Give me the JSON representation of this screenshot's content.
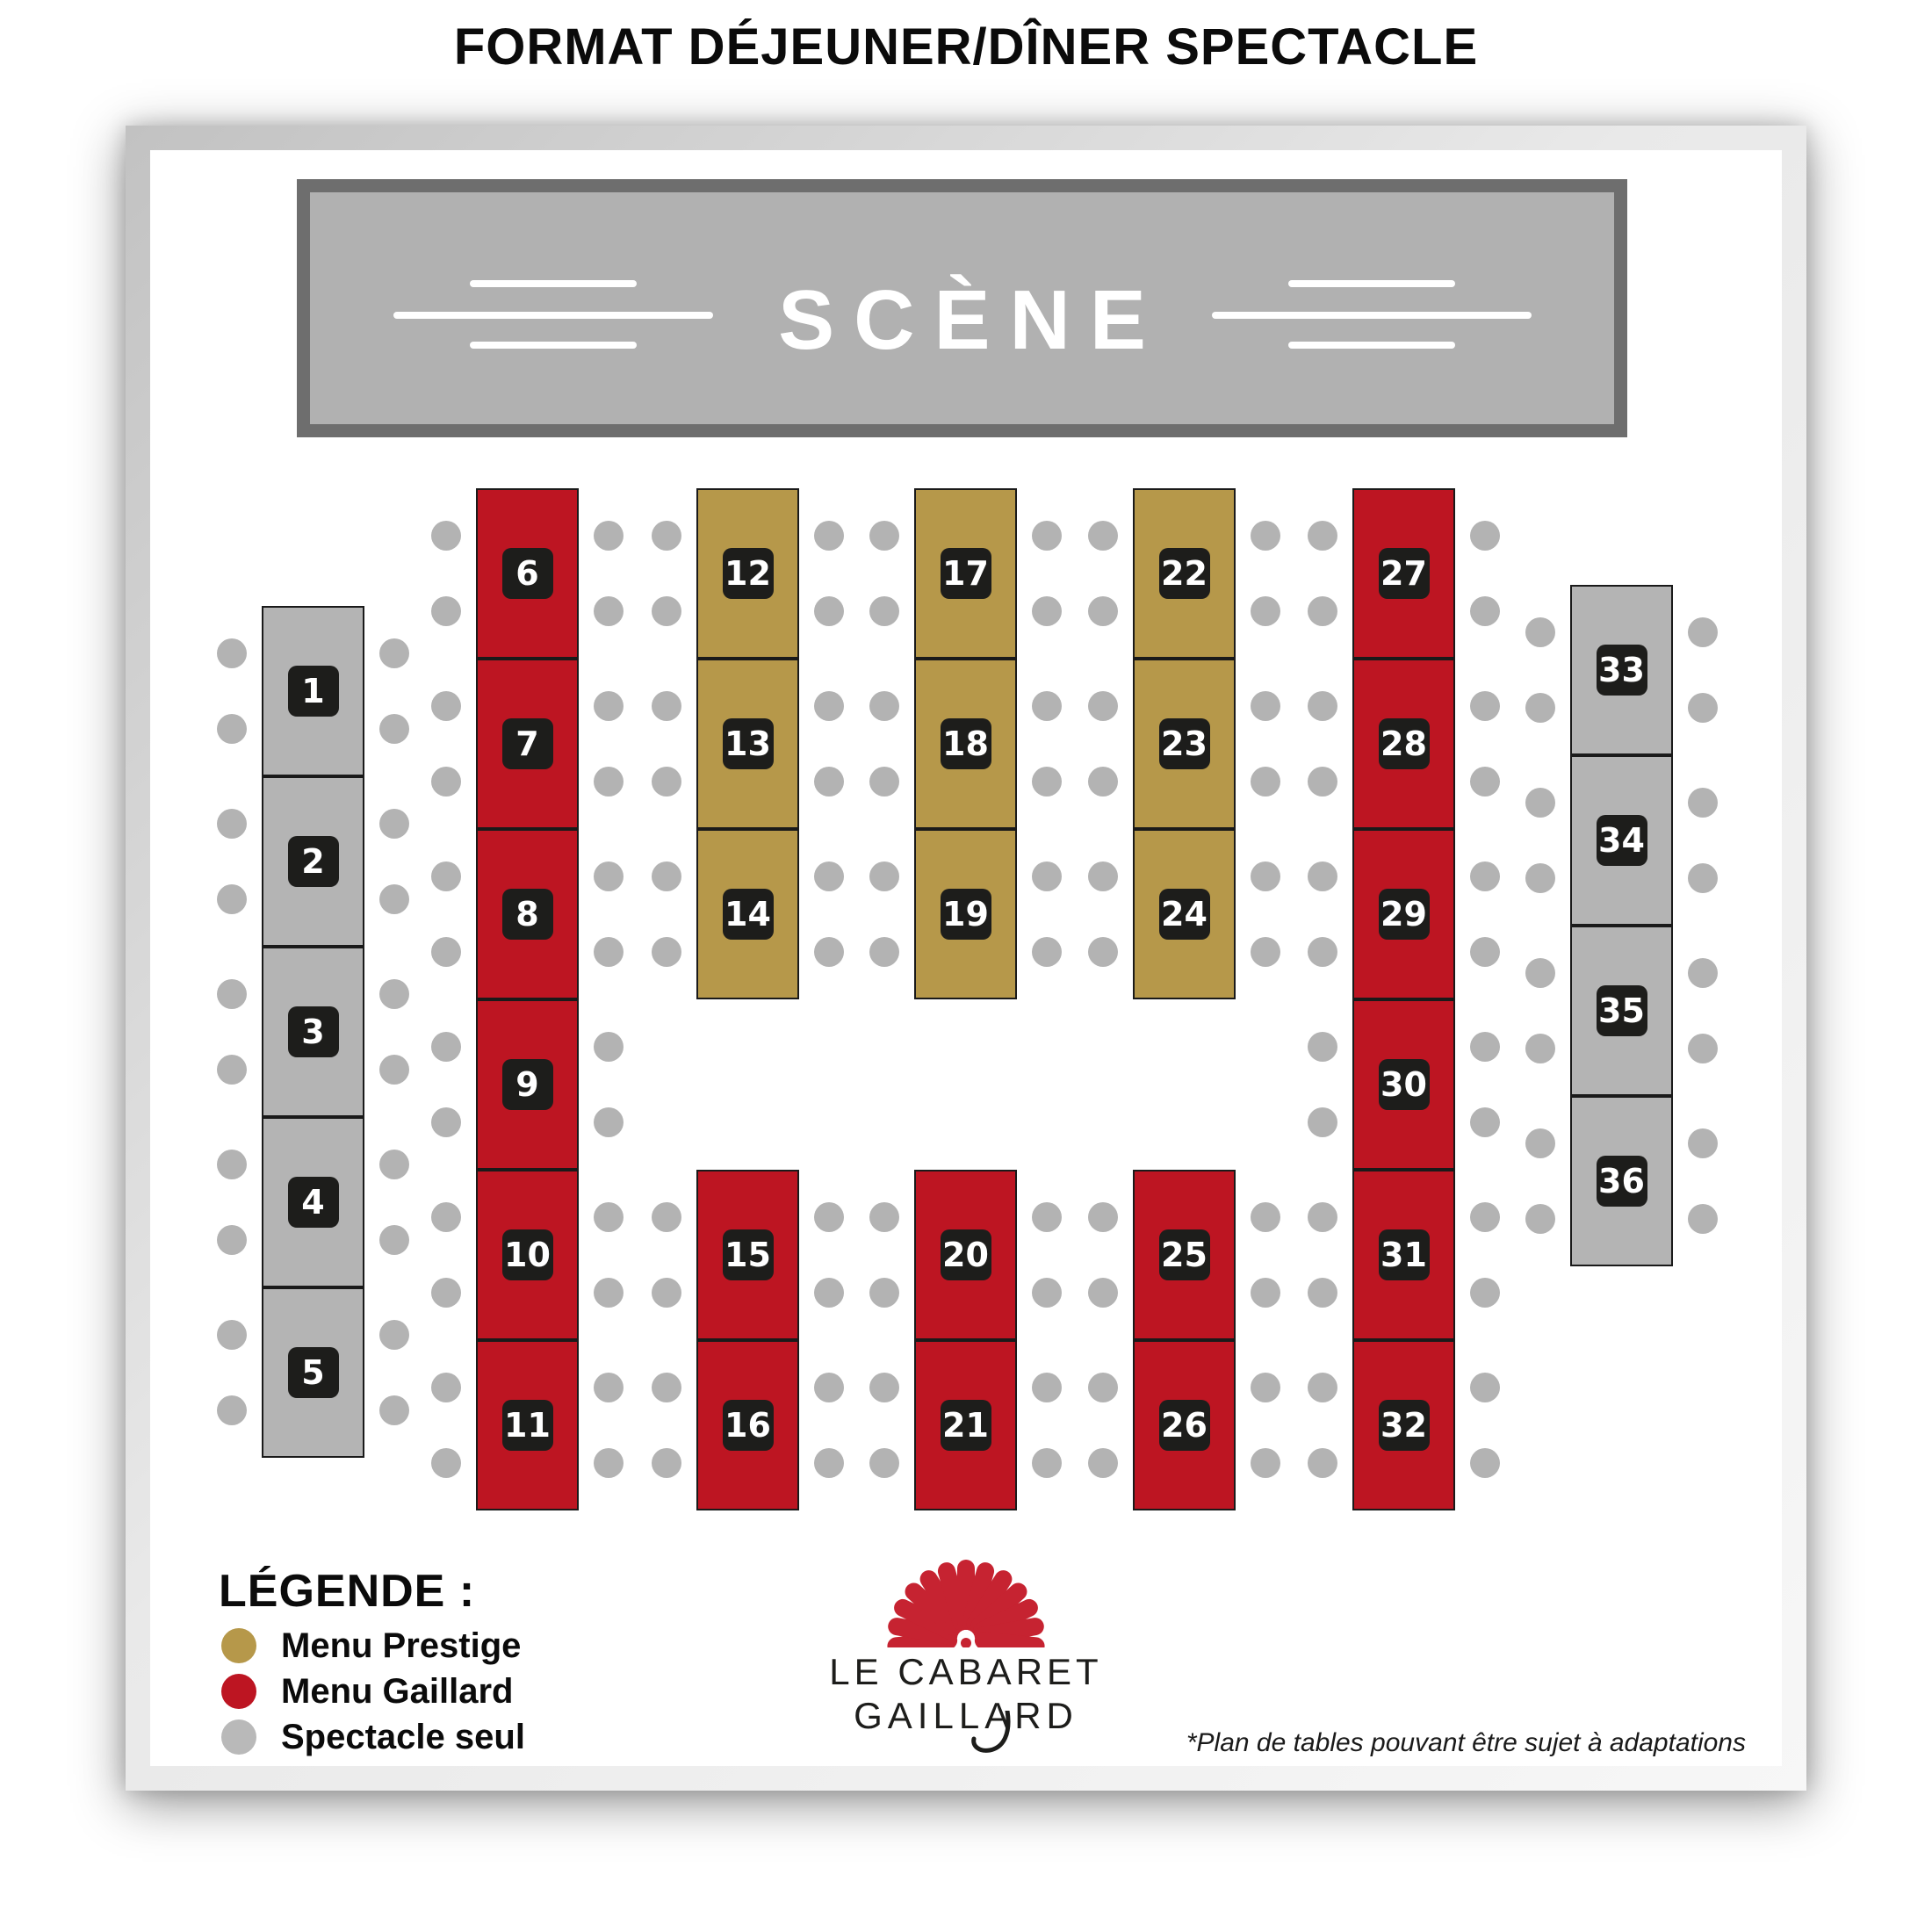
{
  "title": "FORMAT DÉJEUNER/DÎNER SPECTACLE",
  "stage": {
    "label": "SCÈNE"
  },
  "legend": {
    "title": "LÉGENDE :",
    "items": [
      {
        "id": "prestige",
        "label": "Menu Prestige",
        "color": "#b6984a"
      },
      {
        "id": "gaillard",
        "label": "Menu Gaillard",
        "color": "#bd1522"
      },
      {
        "id": "spectacle",
        "label": "Spectacle seul",
        "color": "#b9b9b9"
      }
    ]
  },
  "logo": {
    "line1": "LE CABARET",
    "line2": "GAILLARD"
  },
  "footnote": "*Plan de tables pouvant être sujet à adaptations",
  "colors": {
    "prestige": "#b6984a",
    "gaillard": "#bd1522",
    "spectacle": "#b4b4b4",
    "table_border": "#1a1a1a",
    "badge_bg": "#1d1d1b",
    "badge_text": "#ffffff",
    "chair": "#b3b3b3",
    "stage_fill": "#b1b1b1",
    "stage_border": "#6e6e6e",
    "logo_red": "#c62331",
    "title_text": "#0b0b0b"
  },
  "seatmap": {
    "tables": [
      {
        "n": 1,
        "menu": "spectacle",
        "col": 0,
        "row": 0
      },
      {
        "n": 2,
        "menu": "spectacle",
        "col": 0,
        "row": 1
      },
      {
        "n": 3,
        "menu": "spectacle",
        "col": 0,
        "row": 2
      },
      {
        "n": 4,
        "menu": "spectacle",
        "col": 0,
        "row": 3
      },
      {
        "n": 5,
        "menu": "spectacle",
        "col": 0,
        "row": 4
      },
      {
        "n": 6,
        "menu": "gaillard",
        "col": 1,
        "row": 0
      },
      {
        "n": 7,
        "menu": "gaillard",
        "col": 1,
        "row": 1
      },
      {
        "n": 8,
        "menu": "gaillard",
        "col": 1,
        "row": 2
      },
      {
        "n": 9,
        "menu": "gaillard",
        "col": 1,
        "row": 3
      },
      {
        "n": 10,
        "menu": "gaillard",
        "col": 1,
        "row": 4
      },
      {
        "n": 11,
        "menu": "gaillard",
        "col": 1,
        "row": 5
      },
      {
        "n": 12,
        "menu": "prestige",
        "col": 2,
        "row": 0
      },
      {
        "n": 13,
        "menu": "prestige",
        "col": 2,
        "row": 1
      },
      {
        "n": 14,
        "menu": "prestige",
        "col": 2,
        "row": 2
      },
      {
        "n": 15,
        "menu": "gaillard",
        "col": 2,
        "row": 4
      },
      {
        "n": 16,
        "menu": "gaillard",
        "col": 2,
        "row": 5
      },
      {
        "n": 17,
        "menu": "prestige",
        "col": 3,
        "row": 0
      },
      {
        "n": 18,
        "menu": "prestige",
        "col": 3,
        "row": 1
      },
      {
        "n": 19,
        "menu": "prestige",
        "col": 3,
        "row": 2
      },
      {
        "n": 20,
        "menu": "gaillard",
        "col": 3,
        "row": 4
      },
      {
        "n": 21,
        "menu": "gaillard",
        "col": 3,
        "row": 5
      },
      {
        "n": 22,
        "menu": "prestige",
        "col": 4,
        "row": 0
      },
      {
        "n": 23,
        "menu": "prestige",
        "col": 4,
        "row": 1
      },
      {
        "n": 24,
        "menu": "prestige",
        "col": 4,
        "row": 2
      },
      {
        "n": 25,
        "menu": "gaillard",
        "col": 4,
        "row": 4
      },
      {
        "n": 26,
        "menu": "gaillard",
        "col": 4,
        "row": 5
      },
      {
        "n": 27,
        "menu": "gaillard",
        "col": 5,
        "row": 0
      },
      {
        "n": 28,
        "menu": "gaillard",
        "col": 5,
        "row": 1
      },
      {
        "n": 29,
        "menu": "gaillard",
        "col": 5,
        "row": 2
      },
      {
        "n": 30,
        "menu": "gaillard",
        "col": 5,
        "row": 3
      },
      {
        "n": 31,
        "menu": "gaillard",
        "col": 5,
        "row": 4
      },
      {
        "n": 32,
        "menu": "gaillard",
        "col": 5,
        "row": 5
      },
      {
        "n": 33,
        "menu": "spectacle",
        "col": 6,
        "row": 0
      },
      {
        "n": 34,
        "menu": "spectacle",
        "col": 6,
        "row": 1
      },
      {
        "n": 35,
        "menu": "spectacle",
        "col": 6,
        "row": 2
      },
      {
        "n": 36,
        "menu": "spectacle",
        "col": 6,
        "row": 3
      }
    ]
  }
}
